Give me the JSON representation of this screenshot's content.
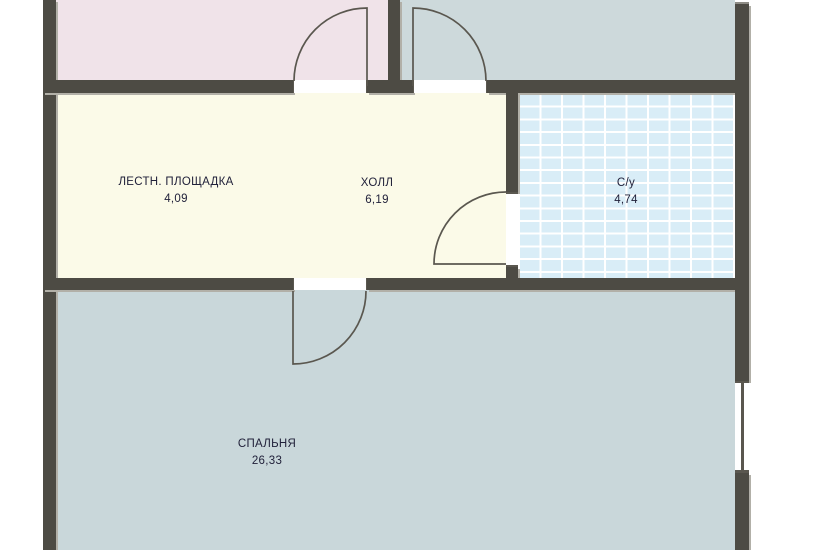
{
  "plan_title": "Floor plan fragment",
  "rooms": [
    {
      "name": "ЛЕСТН. ПЛОЩАДКА",
      "area": "4,09"
    },
    {
      "name": "ХОЛЛ",
      "area": "6,19"
    },
    {
      "name": "С/у",
      "area": "4,74"
    },
    {
      "name": "СПАЛЬНЯ",
      "area": "26,33"
    }
  ],
  "colors": {
    "wall": "#4d4b44",
    "bevel": "#b2b0a8",
    "hall": "#fbfae8",
    "room_pink": "#f0e3e9",
    "room_gray": "#cdd9db",
    "bedroom": "#c9d7da",
    "tile": "#d9edf7",
    "grout": "#ffffff",
    "stroke": "#5a574f",
    "text": "#21213a"
  }
}
